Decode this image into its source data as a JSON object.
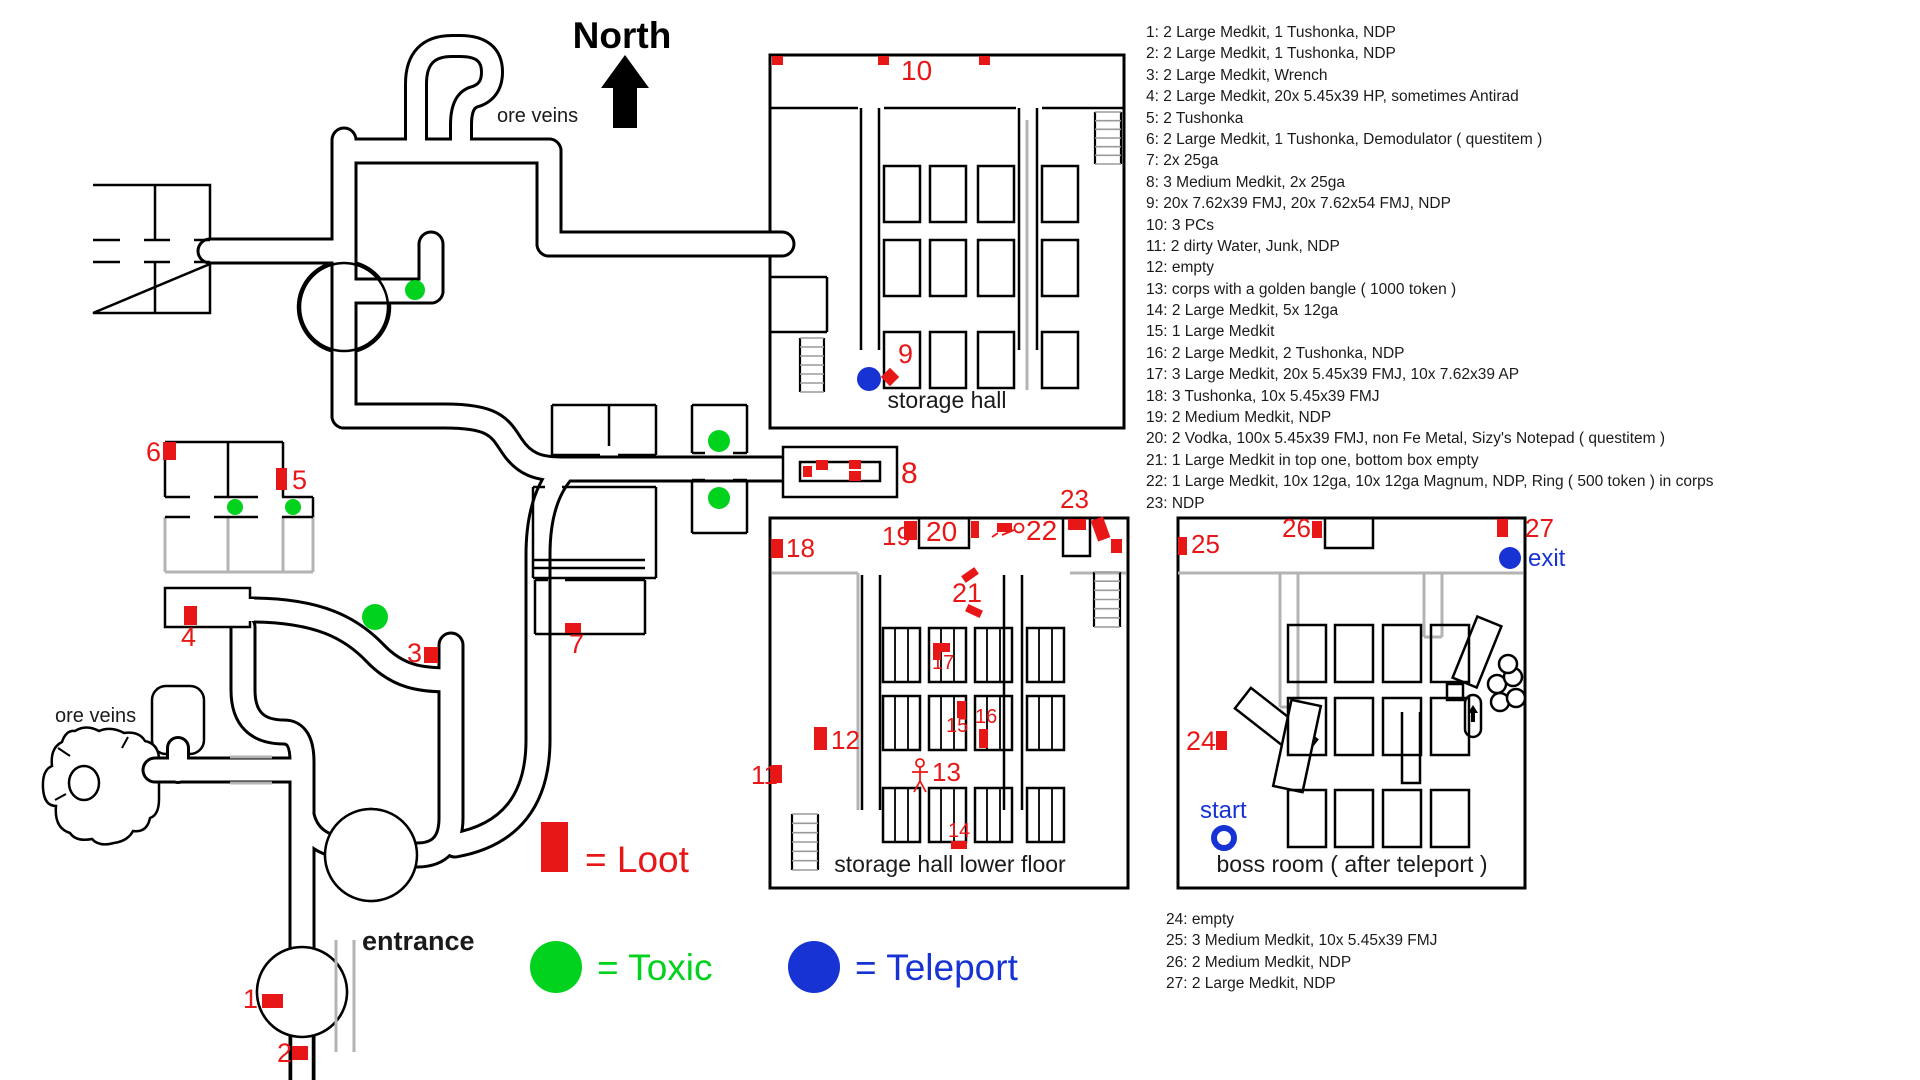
{
  "labels": {
    "north": "North",
    "ore_veins_top": "ore veins",
    "ore_veins_bottom": "ore veins",
    "storage_hall": "storage hall",
    "storage_hall_lower": "storage hall lower floor",
    "boss_room": "boss room ( after teleport )",
    "entrance": "entrance",
    "start": "start",
    "exit": "exit"
  },
  "colors": {
    "loot_red": "#e81717",
    "toxic_green": "#00d21e",
    "teleport_blue": "#1733d4",
    "wall_black": "#000000",
    "underfloor_gray": "#b3b3b3"
  },
  "legend": [
    {
      "name": "loot",
      "shape": "rect",
      "color": "#e81717",
      "label": "= Loot"
    },
    {
      "name": "toxic",
      "shape": "circle",
      "color": "#00d21e",
      "label": "= Toxic"
    },
    {
      "name": "teleport",
      "shape": "circle",
      "color": "#1733d4",
      "label": "= Teleport"
    }
  ],
  "loot_list_top": [
    "1: 2 Large Medkit, 1 Tushonka, NDP",
    "2: 2 Large Medkit, 1 Tushonka, NDP",
    "3: 2 Large Medkit, Wrench",
    "4: 2 Large Medkit, 20x 5.45x39 HP, sometimes Antirad",
    "5: 2 Tushonka",
    "6: 2 Large Medkit, 1 Tushonka, Demodulator ( questitem )",
    "7: 2x 25ga",
    "8: 3 Medium Medkit, 2x 25ga",
    "9: 20x 7.62x39 FMJ, 20x 7.62x54 FMJ, NDP",
    "10: 3 PCs",
    "11: 2 dirty Water, Junk, NDP",
    "12: empty",
    "13: corps with a golden bangle ( 1000 token )",
    "14: 2 Large Medkit, 5x 12ga",
    "15: 1 Large Medkit",
    "16: 2 Large Medkit, 2 Tushonka, NDP",
    "17: 3 Large Medkit, 20x 5.45x39 FMJ, 10x 7.62x39 AP",
    "18: 3 Tushonka, 10x 5.45x39 FMJ",
    "19: 2 Medium Medkit, NDP",
    "20: 2 Vodka, 100x 5.45x39 FMJ, non Fe Metal, Sizy's Notepad ( questitem )",
    "21: 1 Large Medkit in top one, bottom box empty",
    "22: 1 Large Medkit, 10x 12ga, 10x 12ga Magnum, NDP, Ring ( 500 token ) in corps",
    "23: NDP"
  ],
  "loot_list_bottom": [
    "24: empty",
    "25: 3 Medium Medkit, 10x 5.45x39 FMJ",
    "26: 2 Medium Medkit, NDP",
    "27: 2 Large Medkit, NDP"
  ],
  "markers": {
    "loot_boxes": [
      {
        "n": "1",
        "box": [
          262,
          994,
          21,
          14
        ],
        "label": [
          243,
          1008
        ],
        "size": 27
      },
      {
        "n": "2",
        "box": [
          292,
          1046,
          16,
          14
        ],
        "label": [
          277,
          1062
        ],
        "size": 27
      },
      {
        "n": "3",
        "box": [
          424,
          647,
          14,
          16
        ],
        "label": [
          407,
          662
        ],
        "size": 27
      },
      {
        "n": "4",
        "box": [
          184,
          606,
          13,
          19
        ],
        "label": [
          181,
          646
        ],
        "size": 27
      },
      {
        "n": "5",
        "box": [
          276,
          468,
          11,
          22
        ],
        "label": [
          292,
          489
        ],
        "size": 27
      },
      {
        "n": "6",
        "box": [
          163,
          442,
          13,
          18
        ],
        "label": [
          146,
          461
        ],
        "size": 27
      },
      {
        "n": "7",
        "box": [
          565,
          623,
          16,
          10
        ],
        "label": [
          569,
          653
        ],
        "size": 27
      },
      {
        "n": "8",
        "box": null,
        "label": [
          901,
          483
        ],
        "size": 30
      },
      {
        "n": "9",
        "box": null,
        "label": [
          898,
          363
        ],
        "size": 27
      },
      {
        "n": "10",
        "box": null,
        "label": [
          901,
          80
        ],
        "size": 28
      },
      {
        "n": "11",
        "box": [
          771,
          765,
          11,
          18
        ],
        "label": [
          751,
          784
        ],
        "size": 26
      },
      {
        "n": "12",
        "box": [
          814,
          727,
          13,
          23
        ],
        "label": [
          831,
          749
        ],
        "size": 26
      },
      {
        "n": "13",
        "box": null,
        "label": [
          932,
          781
        ],
        "size": 26
      },
      {
        "n": "14",
        "box": [
          951,
          841,
          16,
          8
        ],
        "label": [
          948,
          837
        ],
        "size": 20
      },
      {
        "n": "15",
        "box": [
          957,
          701,
          9,
          17
        ],
        "label": [
          946,
          732
        ],
        "size": 20
      },
      {
        "n": "16",
        "box": [
          979,
          729,
          9,
          19
        ],
        "label": [
          975,
          723
        ],
        "size": 20
      },
      {
        "n": "17",
        "box": null,
        "label": [
          932,
          669
        ],
        "size": 20
      },
      {
        "n": "18",
        "box": [
          771,
          539,
          12,
          19
        ],
        "label": [
          786,
          557
        ],
        "size": 26
      },
      {
        "n": "19",
        "box": [
          904,
          521,
          13,
          19
        ],
        "label": [
          882,
          545
        ],
        "size": 26
      },
      {
        "n": "20",
        "box": [
          971,
          521,
          8,
          17
        ],
        "label": [
          926,
          541
        ],
        "size": 28
      },
      {
        "n": "21",
        "box": null,
        "label": [
          952,
          602
        ],
        "size": 27
      },
      {
        "n": "22",
        "box": null,
        "label": [
          1026,
          540
        ],
        "size": 28
      },
      {
        "n": "23",
        "box": [
          1068,
          519,
          18,
          11
        ],
        "label": [
          1060,
          508
        ],
        "size": 26
      },
      {
        "n": "24",
        "box": [
          1216,
          731,
          11,
          19
        ],
        "label": [
          1186,
          750
        ],
        "size": 27
      },
      {
        "n": "25",
        "box": [
          1178,
          537,
          9,
          18
        ],
        "label": [
          1191,
          553
        ],
        "size": 26
      },
      {
        "n": "26",
        "box": [
          1312,
          521,
          10,
          17
        ],
        "label": [
          1282,
          537
        ],
        "size": 26
      },
      {
        "n": "27",
        "box": [
          1497,
          519,
          11,
          18
        ],
        "label": [
          1525,
          537
        ],
        "size": 26
      }
    ],
    "extra_loot_shapes": {
      "eight_boxes": [
        [
          803,
          466,
          9,
          11
        ],
        [
          816,
          460,
          12,
          10
        ],
        [
          849,
          460,
          12,
          9
        ],
        [
          849,
          471,
          12,
          10
        ]
      ],
      "nine_diamond": [
        890,
        377,
        13
      ],
      "ten_boxes": [
        [
          772,
          56,
          11,
          9
        ],
        [
          878,
          56,
          11,
          9
        ],
        [
          979,
          56,
          11,
          9
        ]
      ],
      "seventeen_L": [
        [
          933,
          643,
          17,
          9
        ],
        [
          933,
          652,
          8,
          8
        ]
      ],
      "twentyone_boxes": [
        [
          962,
          571,
          16,
          8,
          -35
        ],
        [
          966,
          607,
          16,
          8,
          25
        ]
      ],
      "twentytwo_box": [
        997,
        523,
        15,
        9
      ],
      "corner_boxes": [
        [
          1094,
          518,
          13,
          22,
          -20
        ],
        [
          1111,
          539,
          11,
          14,
          0
        ]
      ]
    },
    "toxic": [
      [
        415,
        290,
        10
      ],
      [
        235,
        507,
        8
      ],
      [
        293,
        507,
        8
      ],
      [
        375,
        617,
        13
      ],
      [
        719,
        441,
        11
      ],
      [
        719,
        498,
        11
      ]
    ],
    "teleport": [
      [
        869,
        379,
        12
      ],
      [
        1510,
        558,
        11
      ]
    ],
    "start_ring": [
      1224,
      838,
      10
    ]
  }
}
